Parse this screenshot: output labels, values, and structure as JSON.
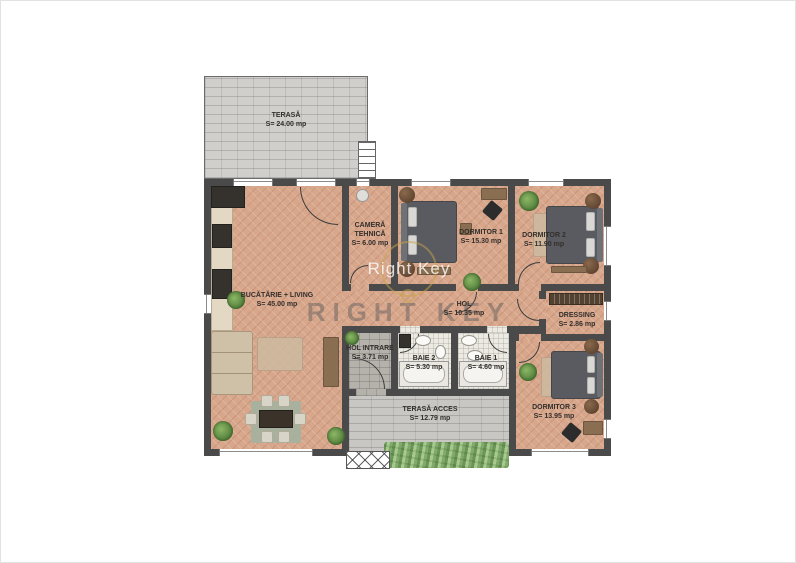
{
  "plan": {
    "title": "Floor plan",
    "watermark": {
      "line1": "Right Key",
      "line2": "RIGHT KEY"
    },
    "colors": {
      "wall": "#4a4a4a",
      "wood_floor": "#d7a68b",
      "terrace_floor": "#d0cfcc",
      "stone_floor": "#b5b2ac",
      "paver_floor": "#c8c7c3",
      "bathroom_floor": "#eceae2",
      "hedge_green": "#86b06a",
      "watermark_gold": "#c7a44a"
    },
    "rooms": [
      {
        "id": "terasa",
        "name": "TERASĂ",
        "area": "S= 24.00 mp"
      },
      {
        "id": "bucatarie-living",
        "name": "BUCĂTĂRIE + LIVING",
        "area": "S= 45.00 mp"
      },
      {
        "id": "camera-tehnica",
        "name": "CAMERĂ TEHNICĂ",
        "area": "S= 6.00 mp"
      },
      {
        "id": "dormitor-1",
        "name": "DORMITOR 1",
        "area": "S= 15.30 mp"
      },
      {
        "id": "dormitor-2",
        "name": "DORMITOR 2",
        "area": "S= 11.90 mp"
      },
      {
        "id": "hol",
        "name": "HOL",
        "area": "S= 10.35 mp"
      },
      {
        "id": "dressing",
        "name": "DRESSING",
        "area": "S= 2.86 mp"
      },
      {
        "id": "hol-intrare",
        "name": "HOL INTRARE",
        "area": "S= 3.71 mp"
      },
      {
        "id": "baie-2",
        "name": "BAIE 2",
        "area": "S= 5.30 mp"
      },
      {
        "id": "baie-1",
        "name": "BAIE 1",
        "area": "S= 4.60 mp"
      },
      {
        "id": "dormitor-3",
        "name": "DORMITOR 3",
        "area": "S= 13.95 mp"
      },
      {
        "id": "terasa-acces",
        "name": "TERASĂ ACCES",
        "area": "S= 12.79 mp"
      }
    ]
  }
}
